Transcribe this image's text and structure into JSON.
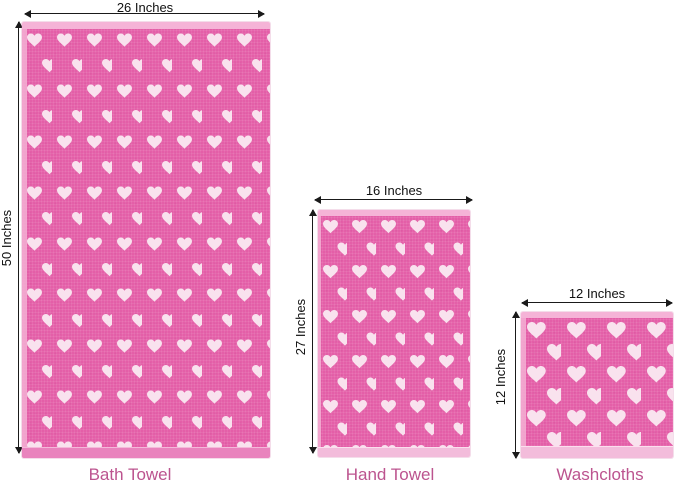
{
  "towels": [
    {
      "name": "Bath Towel",
      "width_label": "26 Inches",
      "height_label": "50 Inches"
    },
    {
      "name": "Hand Towel",
      "width_label": "16 Inches",
      "height_label": "27 Inches"
    },
    {
      "name": "Washcloths",
      "width_label": "12 Inches",
      "height_label": "12 Inches"
    }
  ],
  "colors": {
    "towel_body_pink": "#e45fa8",
    "towel_edge_light_pink": "#f5b3d7",
    "bath_hem_pink": "#e983bd",
    "light_hem_pink": "#f3bcdb",
    "heart_white_pink": "#f9e2ee",
    "caption_pink": "#bc548f",
    "dimension_text": "#111111",
    "background": "#ffffff"
  }
}
